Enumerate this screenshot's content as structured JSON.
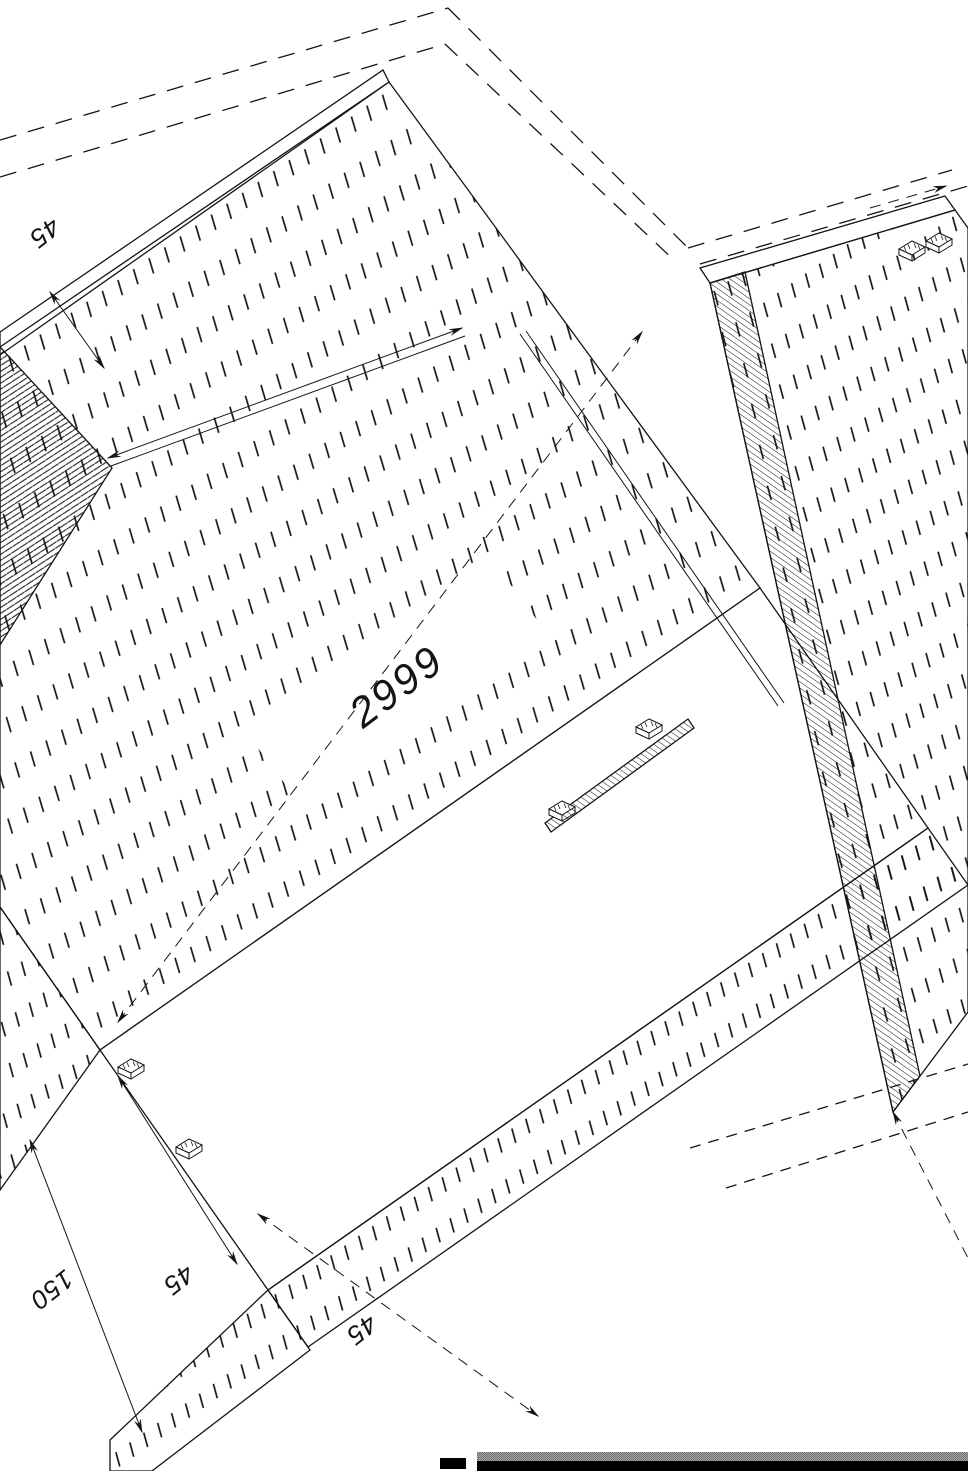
{
  "drawing": {
    "dimension_labels": {
      "length": "2999",
      "top_thickness": "45",
      "left_outer": "150",
      "left_inner": "45",
      "bottom": "45"
    },
    "symbols": [
      "arrowhead",
      "fixing-clip",
      "section-hatch",
      "phantom-outline"
    ],
    "colors": {
      "line": "#141414",
      "background": "#ffffff"
    }
  },
  "ui": {
    "bottom_bar": {
      "gray": "#a9a9a9",
      "black": "#000000"
    }
  }
}
